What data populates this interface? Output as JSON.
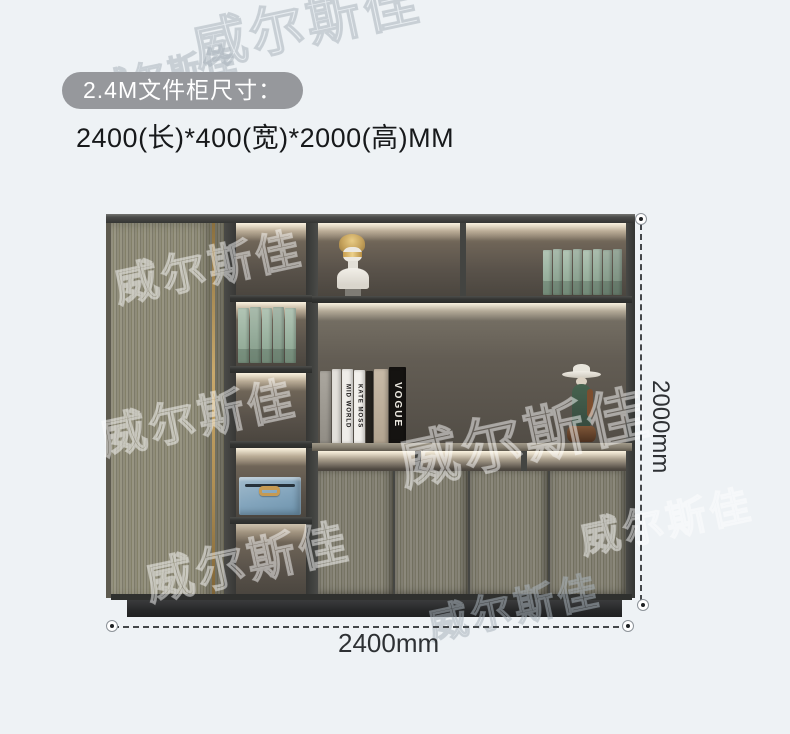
{
  "page": {
    "background_color": "#eef2f5"
  },
  "header": {
    "badge_label": "2.4M文件柜尺寸：",
    "size_text": "2400(长)*400(宽)*2000(高)MM"
  },
  "dimensions": {
    "width_label": "2400mm",
    "height_label": "2000mm"
  },
  "watermark_text": "威尔斯佳",
  "cabinet": {
    "book_spine_labels": [
      "MID WORLD",
      "KATE MOSS",
      "VOGUE"
    ],
    "decor_items": [
      "roman-bust",
      "green-binders",
      "blue-storage-box",
      "lady-figurine",
      "fashion-books"
    ],
    "colors": {
      "badge_background": "#96989c",
      "wood_light": "#8f8c7a",
      "wood_doors": "#817e72",
      "frame_dark": "#3e3f3c",
      "interior_back": "#5f574d",
      "led_glow": "#fdf6e7",
      "green_books": "#9fb6a4",
      "blue_box": "#82a4bc",
      "gold_accent": "#c4a368",
      "plinth": "#2b2c2d",
      "dimension_line": "#44474a"
    }
  }
}
